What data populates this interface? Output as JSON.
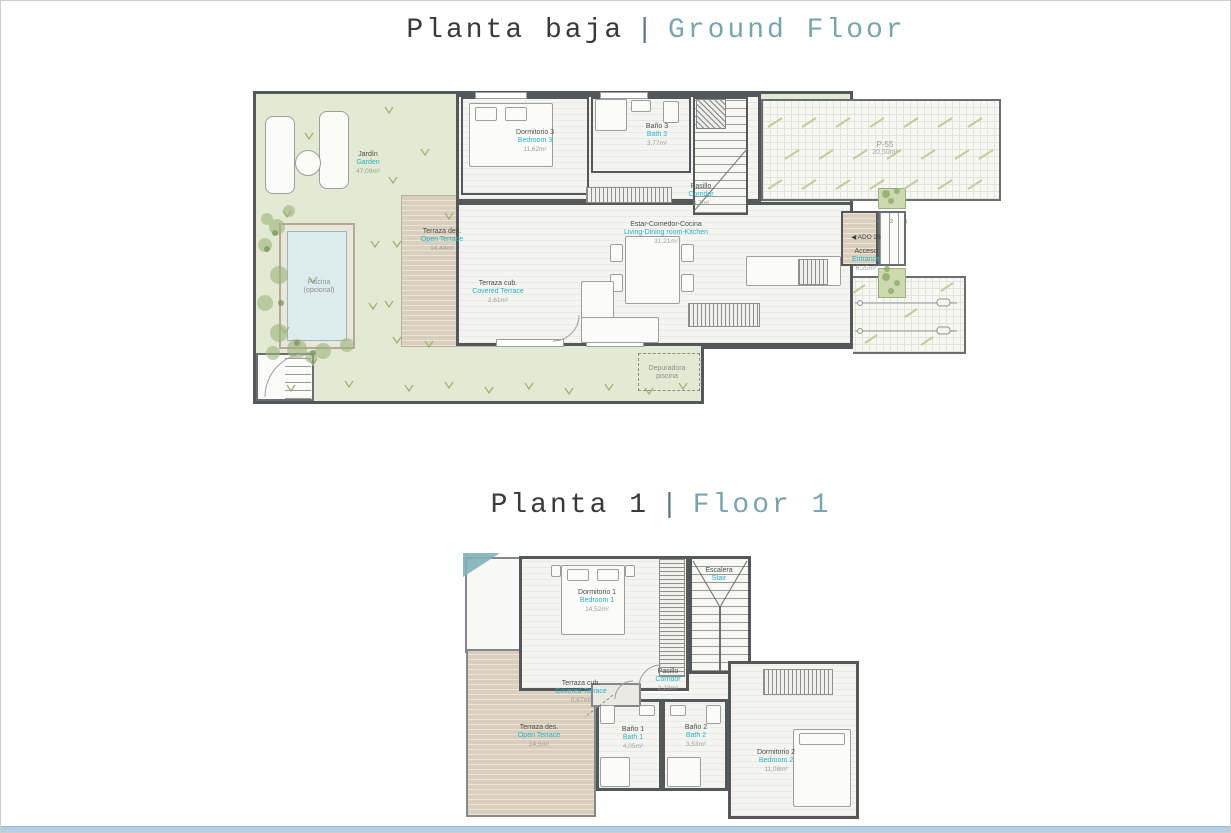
{
  "titles": {
    "ground": {
      "es": "Planta baja",
      "sep": "|",
      "en": "Ground Floor"
    },
    "floor1": {
      "es": "Planta 1",
      "sep": "|",
      "en": "Floor 1"
    }
  },
  "ground_floor": {
    "garden": {
      "es": "Jardín",
      "en": "Garden",
      "area": "47,09m²"
    },
    "pool": {
      "line1": "Piscina",
      "line2": "(opcional)"
    },
    "open_terrace": {
      "es": "Terraza des.",
      "en": "Open Terrace",
      "area": "14,44m²"
    },
    "covered_terrace": {
      "es": "Terraza cub.",
      "en": "Covered Terrace",
      "area": "2,61m²"
    },
    "bedroom3": {
      "es": "Dormitorio 3",
      "en": "Bedroom 3",
      "area": "11,62m²"
    },
    "bath3": {
      "es": "Baño 3",
      "en": "Bath 3",
      "area": "3,77m²"
    },
    "corridor": {
      "es": "Pasillo",
      "en": "Corridor",
      "area": "3,7m²"
    },
    "living": {
      "es": "Estar-Comedor-Cocina",
      "en": "Living-Dining room-Kitchen",
      "area": "31,21m²"
    },
    "entrance": {
      "marker": "◀ ADO 26",
      "es": "Acceso",
      "en": "Entrance",
      "area": "6,25m²",
      "steps": "3 2 1"
    },
    "parking": {
      "name": "P-55",
      "area": "20,50m²"
    },
    "pool_equipment": {
      "line1": "Depuradora",
      "line2": "piscina"
    }
  },
  "floor1": {
    "bedroom1": {
      "es": "Dormitorio 1",
      "en": "Bedroom 1",
      "area": "14,52m²"
    },
    "stair": {
      "es": "Escalera",
      "en": "Stair"
    },
    "corridor": {
      "es": "Pasillo",
      "en": "Corridor",
      "area": "2,23m²"
    },
    "covered_terrace": {
      "es": "Terraza cub.",
      "en": "Covered Terrace",
      "area": "0,67m²"
    },
    "open_terrace": {
      "es": "Terraza des.",
      "en": "Open Terrace",
      "area": "14,5m²"
    },
    "bath1": {
      "es": "Baño 1",
      "en": "Bath 1",
      "area": "4,05m²"
    },
    "bath2": {
      "es": "Baño 2",
      "en": "Bath 2",
      "area": "3,53m²"
    },
    "bedroom2": {
      "es": "Dormitorio 2",
      "en": "Bedroom 2",
      "area": "11,08m²"
    }
  },
  "colors": {
    "accent_teal": "#26b2c7",
    "title_teal": "#7aa4ae",
    "title_text": "#3a3a3a",
    "garden_green": "#e3e9d3",
    "terrace_tan": "#d9cfbc",
    "pool_blue": "#dcecee",
    "wall_gray": "#54585b",
    "bottom_bar_blue": "#b6cfe3"
  }
}
